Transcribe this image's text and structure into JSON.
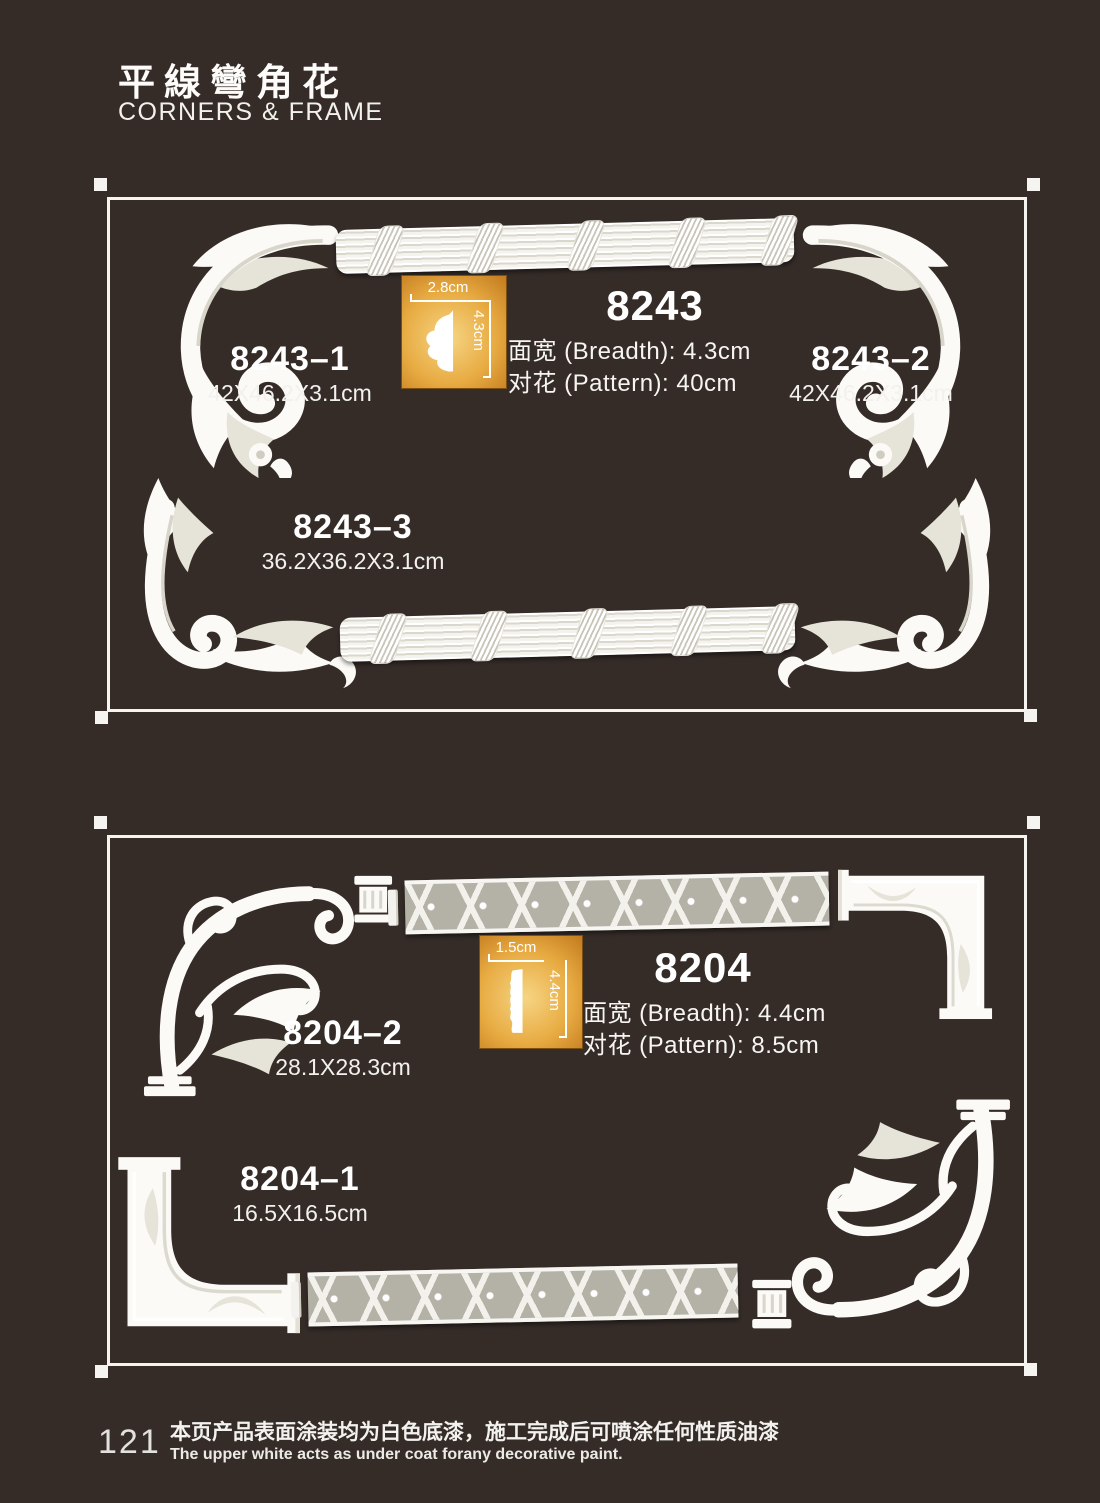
{
  "page": {
    "title_zh": "平線彎角花",
    "title_en": "CORNERS & FRAME",
    "page_number": "121",
    "footer_zh": "本页产品表面涂装均为白色底漆，施工完成后可喷涂任何性质油漆",
    "footer_en": "The upper white acts as under coat forany decorative paint.",
    "bg_color": "#352c28",
    "accent_orange": "#e8ab42"
  },
  "s1": {
    "code": "8243",
    "breadth": "面宽 (Breadth): 4.3cm",
    "pattern": "对花 (Pattern): 40cm",
    "profile": {
      "width": "2.8cm",
      "height": "4.3cm"
    },
    "items": [
      {
        "code": "8243–1",
        "size": "42X46.2X3.1cm"
      },
      {
        "code": "8243–2",
        "size": "42X46.2X3.1cm"
      },
      {
        "code": "8243–3",
        "size": "36.2X36.2X3.1cm"
      }
    ]
  },
  "s2": {
    "code": "8204",
    "breadth": "面宽 (Breadth): 4.4cm",
    "pattern": "对花 (Pattern): 8.5cm",
    "profile": {
      "width": "1.5cm",
      "height": "4.4cm"
    },
    "items": [
      {
        "code": "8204–2",
        "size": "28.1X28.3cm"
      },
      {
        "code": "8204–1",
        "size": "16.5X16.5cm"
      }
    ]
  }
}
